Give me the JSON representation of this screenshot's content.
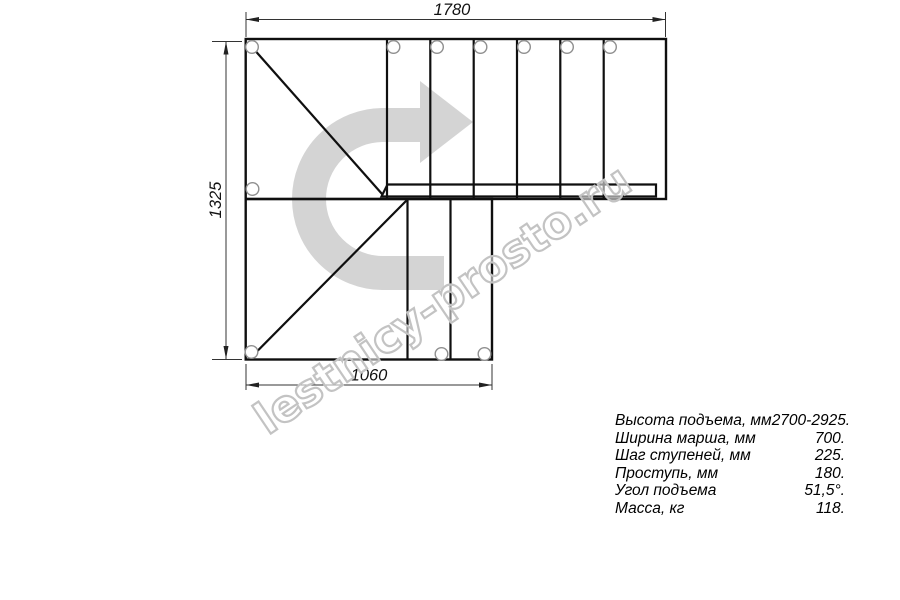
{
  "drawing": {
    "dimension_top": "1780",
    "dimension_left": "1325",
    "dimension_bottom": "1060",
    "watermark": "lestnicy-prosto.ru"
  },
  "specs": {
    "rows": [
      {
        "label": "Высота подъема, мм",
        "value": "2700-2925."
      },
      {
        "label": "Ширина марша, мм",
        "value": "700."
      },
      {
        "label": "Шаг ступеней, мм",
        "value": "225."
      },
      {
        "label": "Проступь, мм",
        "value": "180."
      },
      {
        "label": "Угол подъема",
        "value": "51,5°."
      },
      {
        "label": "Масса, кг",
        "value": "118."
      }
    ]
  },
  "colors": {
    "line": "#0f0f0f",
    "dimension": "#333333",
    "arrow": "#d4d4d4",
    "watermark_outline": "#c3c3c3",
    "circle": "#8f8f8f",
    "background": "#ffffff"
  }
}
